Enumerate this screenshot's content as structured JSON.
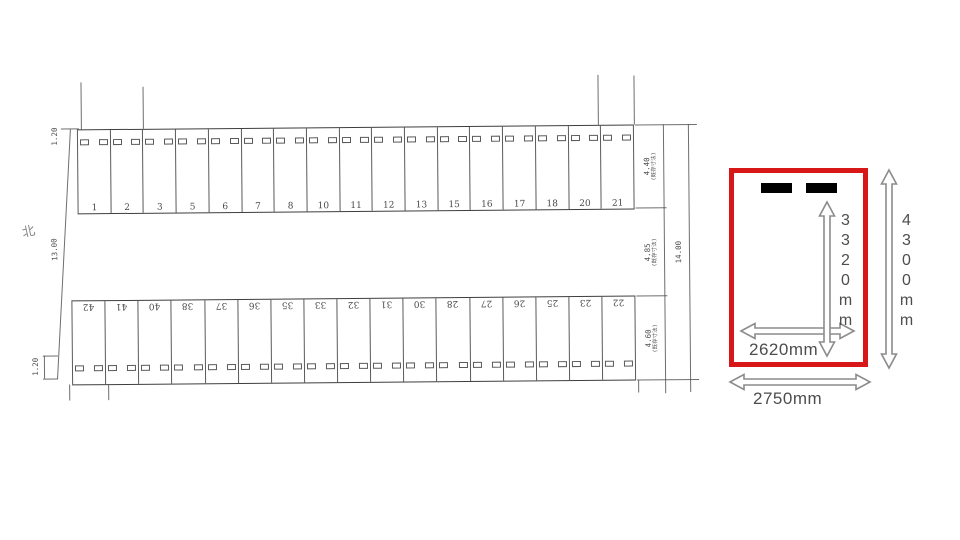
{
  "drawing": {
    "north_label": "北",
    "dims_left": {
      "top_setback": "1.20",
      "boundary_length": "13.00",
      "bottom_setback": "1.20"
    },
    "rows": {
      "top_numbers": [
        "1",
        "2",
        "3",
        "5",
        "6",
        "7",
        "8",
        "10",
        "11",
        "12",
        "13",
        "15",
        "16",
        "17",
        "18",
        "20",
        "21"
      ],
      "bottom_numbers": [
        "42",
        "41",
        "40",
        "38",
        "37",
        "36",
        "35",
        "33",
        "32",
        "31",
        "30",
        "28",
        "27",
        "26",
        "25",
        "23",
        "22"
      ]
    },
    "dims_right": {
      "top_row_depth": "4.40",
      "top_row_note": "(既存寸法)",
      "aisle_width": "4.85",
      "aisle_note": "(既存寸法)",
      "bottom_row_depth": "4.60",
      "bottom_row_note": "(既存寸法)",
      "overall_depth": "14.00"
    }
  },
  "detail": {
    "highlight_color": "#d71718",
    "arrow_color": "#8c8c8c",
    "inner_depth": "3320mm",
    "outer_depth": "4300mm",
    "inner_width": "2620mm",
    "outer_width": "2750mm"
  }
}
